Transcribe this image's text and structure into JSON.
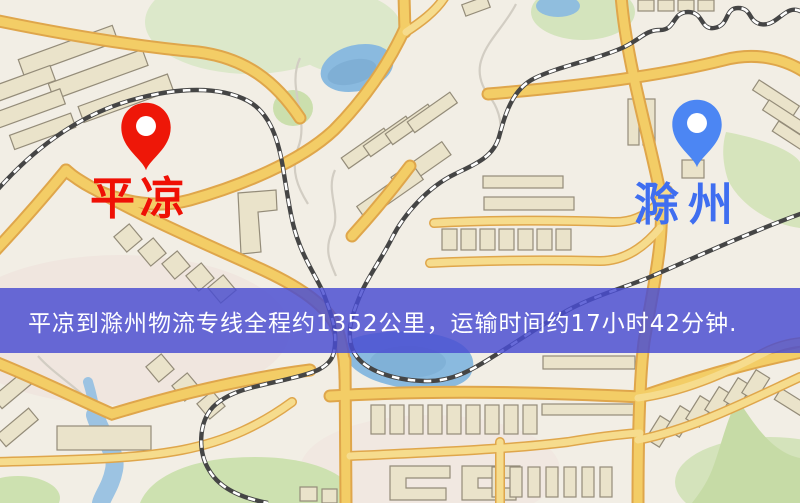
{
  "map": {
    "banner": {
      "text": "平凉到滁州物流专线全程约1352公里，运输时间约17小时42分钟."
    },
    "origin": {
      "label": "平凉"
    },
    "destination": {
      "label": "滁州"
    },
    "colors": {
      "origin_pin": "#ee1708",
      "origin_label": "#ef1005",
      "destination_pin": "#4c86f3",
      "destination_label": "#3f6ef0",
      "banner_background": "rgba(73,77,209,0.83)",
      "banner_text": "#ffffff",
      "road": "#f3cd66",
      "road_casing": "#dfa64b",
      "railway": "#454545",
      "water": "#8abadf",
      "park": "#cde1b0",
      "building": "#eae3ca"
    }
  }
}
